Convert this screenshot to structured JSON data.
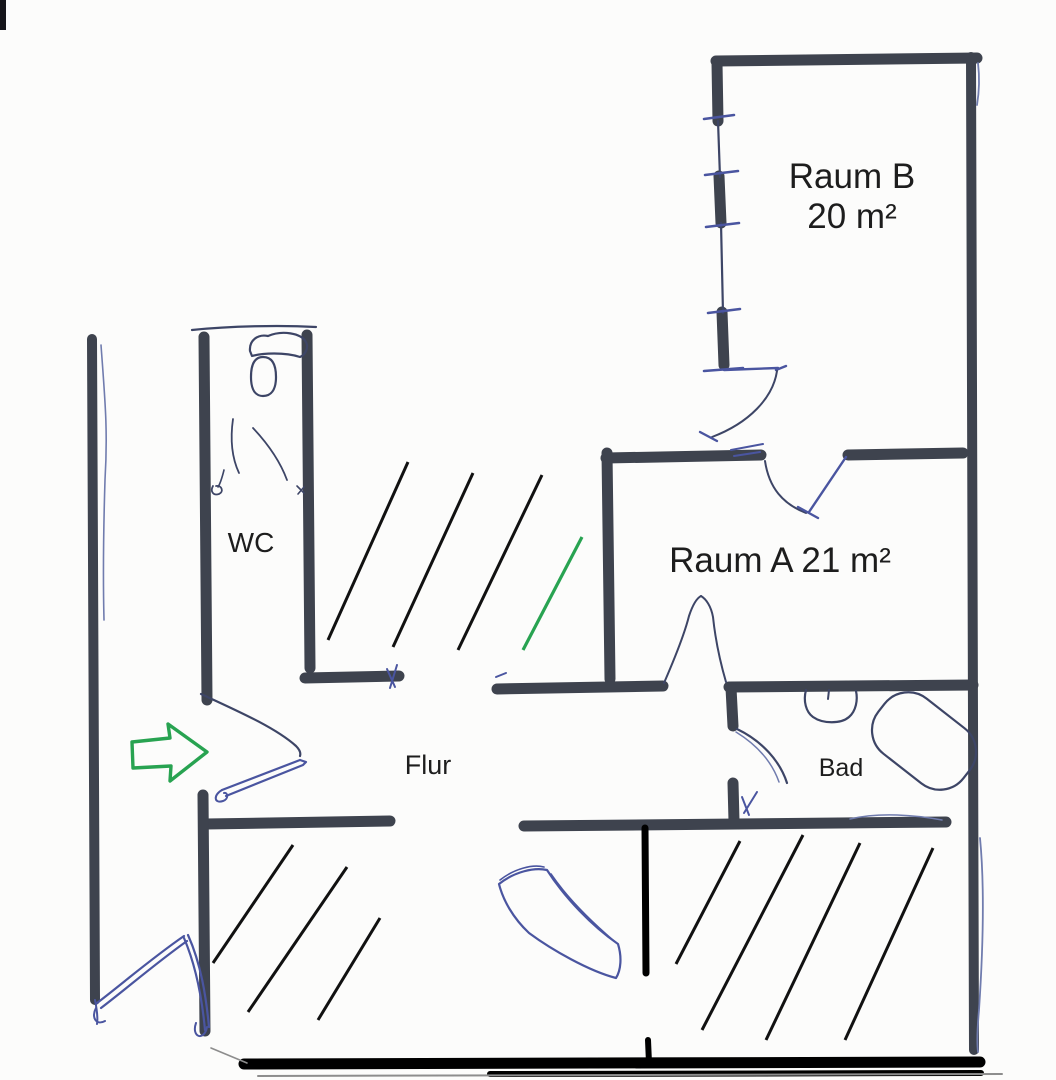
{
  "canvas": {
    "width": 1056,
    "height": 1080,
    "background": "#fcfcfb"
  },
  "palette": {
    "wall": "#3e434e",
    "pen": "#3d4566",
    "pen_blue": "#4a55a0",
    "pen_light": "#707cae",
    "hatch": "#111111",
    "black": "#000000",
    "green": "#28a351",
    "grey": "#8d8d8d",
    "text": "#1d1d1d"
  },
  "rooms": {
    "raum_b": {
      "name": "Raum B",
      "area": "20 m²"
    },
    "raum_a": {
      "label": "Raum A 21 m²"
    },
    "wc": {
      "label": "WC"
    },
    "flur": {
      "label": "Flur"
    },
    "bad": {
      "label": "Bad"
    }
  },
  "plan": {
    "walls": [
      {
        "n": "outer-wall-left",
        "x1": 92,
        "y1": 339,
        "x2": 95,
        "y2": 1000,
        "w": 10
      },
      {
        "n": "raum-b-wall-top",
        "x1": 716,
        "y1": 61,
        "x2": 977,
        "y2": 58,
        "w": 11
      },
      {
        "n": "outer-wall-right",
        "x1": 971,
        "y1": 57,
        "x2": 974,
        "y2": 1050,
        "w": 10
      },
      {
        "n": "raum-b-wall-left-a",
        "x1": 717,
        "y1": 63,
        "x2": 718,
        "y2": 121,
        "w": 11
      },
      {
        "n": "raum-b-wall-left-b",
        "x1": 719,
        "y1": 176,
        "x2": 721,
        "y2": 223,
        "w": 11
      },
      {
        "n": "raum-b-wall-left-c",
        "x1": 722,
        "y1": 312,
        "x2": 724,
        "y2": 365,
        "w": 11
      },
      {
        "n": "raum-a-wall-top-left",
        "x1": 606,
        "y1": 458,
        "x2": 761,
        "y2": 455,
        "w": 11
      },
      {
        "n": "raum-a-wall-top-right",
        "x1": 848,
        "y1": 455,
        "x2": 963,
        "y2": 453,
        "w": 11
      },
      {
        "n": "raum-a-wall-left",
        "x1": 607,
        "y1": 453,
        "x2": 610,
        "y2": 679,
        "w": 11
      },
      {
        "n": "flur-wall-top",
        "x1": 497,
        "y1": 689,
        "x2": 663,
        "y2": 686,
        "w": 11
      },
      {
        "n": "bad-wall-top",
        "x1": 729,
        "y1": 687,
        "x2": 973,
        "y2": 685,
        "w": 11
      },
      {
        "n": "bad-wall-left-a",
        "x1": 731,
        "y1": 688,
        "x2": 733,
        "y2": 726,
        "w": 11
      },
      {
        "n": "bad-wall-left-b",
        "x1": 733,
        "y1": 783,
        "x2": 734,
        "y2": 821,
        "w": 11
      },
      {
        "n": "flur-wall-bottom-left",
        "x1": 206,
        "y1": 824,
        "x2": 390,
        "y2": 821,
        "w": 11
      },
      {
        "n": "flur-wall-bottom-right",
        "x1": 524,
        "y1": 826,
        "x2": 946,
        "y2": 822,
        "w": 11
      },
      {
        "n": "wc-wall-left-upper",
        "x1": 204,
        "y1": 337,
        "x2": 207,
        "y2": 700,
        "w": 11
      },
      {
        "n": "wc-wall-left-lower",
        "x1": 203,
        "y1": 795,
        "x2": 205,
        "y2": 1031,
        "w": 11
      },
      {
        "n": "wc-wall-right",
        "x1": 307,
        "y1": 335,
        "x2": 310,
        "y2": 668,
        "w": 11
      },
      {
        "n": "wc-wall-corner",
        "x1": 305,
        "y1": 678,
        "x2": 399,
        "y2": 676,
        "w": 11
      },
      {
        "n": "black-wall-vertical",
        "x1": 645,
        "y1": 828,
        "x2": 646,
        "y2": 973,
        "w": 7,
        "c": "black"
      },
      {
        "n": "black-wall-vertical-lower",
        "x1": 648,
        "y1": 1040,
        "x2": 649,
        "y2": 1063,
        "w": 6,
        "c": "black"
      },
      {
        "n": "outer-wall-bottom",
        "x1": 244,
        "y1": 1064,
        "x2": 980,
        "y2": 1062,
        "w": 11,
        "c": "black"
      },
      {
        "n": "outer-wall-bottom-2",
        "x1": 490,
        "y1": 1074,
        "x2": 981,
        "y2": 1073,
        "w": 6,
        "c": "black"
      }
    ],
    "pen_paths": [
      {
        "n": "wc-wall-top-sketch",
        "d": "M 192,330 C 230,326 280,325 316,327",
        "w": 2.2
      },
      {
        "n": "toilet-tank-sketch",
        "d": "M 250,351 C 249,340 258,334 268,336 C 282,330 301,333 306,342 C 309,348 305,355 300,357 C 285,352 262,353 252,356 Z",
        "w": 2.2
      },
      {
        "n": "toilet-bowl-sketch",
        "d": "M 263,357 C 273,357 276,366 276,377 C 276,390 271,396 263,396 C 255,396 251,389 251,377 C 251,365 254,357 263,357",
        "w": 2.2
      },
      {
        "n": "wc-sketch-curve",
        "d": "M 233,419 C 230,440 232,458 239,473",
        "w": 1.8
      },
      {
        "n": "wc-sketch-curve",
        "d": "M 253,428 C 268,444 280,461 287,480",
        "w": 1.8
      },
      {
        "n": "wc-sketch-curve",
        "d": "M 224,470 C 222,478 220,484 218,487",
        "w": 1.6
      },
      {
        "n": "wc-hinge-circle",
        "d": "M 213,486 C 210,491 213,496 219,494 C 224,492 222,485 216,486",
        "w": 1.8
      },
      {
        "n": "wc-hinge-mark",
        "d": "M 297,486 L 304,493 M 304,487 L 298,494",
        "w": 1.6
      },
      {
        "n": "left-wall-pen-line",
        "d": "M 101,345 C 105,400 108,430 105,480 C 103,545 103,580 104,620",
        "w": 1.6,
        "c": "pen_light"
      },
      {
        "n": "raum-b-wall-thin",
        "d": "M 718,121 L 720,177 M 721,223 L 723,313",
        "w": 2.2
      },
      {
        "n": "window-ticks",
        "d": "M 704,119 L 734,115 M 705,175 L 738,171 M 706,227 L 739,223 M 708,313 L 740,309 M 704,371 L 743,368",
        "w": 2.6,
        "c": "pen_blue"
      },
      {
        "n": "raum-b-door-line",
        "d": "M 724,370 L 778,368 M 786,366 L 776,370",
        "w": 2.4,
        "c": "pen_blue"
      },
      {
        "n": "raum-b-door-swing",
        "d": "M 777,371 C 773,398 749,423 712,437",
        "w": 2
      },
      {
        "n": "raum-b-door-tick",
        "d": "M 700,432 L 717,441",
        "w": 2.4,
        "c": "pen_blue"
      },
      {
        "n": "raum-a-door-leaf",
        "d": "M 846,457 L 809,512",
        "w": 2.4,
        "c": "pen_blue"
      },
      {
        "n": "raum-a-door-swing",
        "d": "M 765,461 C 769,488 783,504 806,513",
        "w": 2
      },
      {
        "n": "raum-a-door-tick",
        "d": "M 798,507 L 818,518",
        "w": 2.4,
        "c": "pen_blue"
      },
      {
        "n": "raum-a-door-scribble",
        "d": "M 731,450 L 763,444 M 734,456 L 760,452",
        "w": 2,
        "c": "pen_blue"
      },
      {
        "n": "flur-door-swing",
        "d": "M 664,683 C 674,660 684,636 689,616 C 693,604 697,598 701,596",
        "w": 2
      },
      {
        "n": "flur-door-swing",
        "d": "M 726,682 C 719,658 715,636 713,617 C 711,606 706,599 701,596",
        "w": 2
      },
      {
        "n": "bad-door-swing",
        "d": "M 737,729 C 762,741 780,761 787,783",
        "w": 2.2
      },
      {
        "n": "bad-door-swing-2",
        "d": "M 736,732 C 757,745 772,762 779,782",
        "w": 1.5,
        "c": "pen_light"
      },
      {
        "n": "bad-door-scribble",
        "d": "M 744,813 L 757,792 M 749,815 L 742,797",
        "w": 2,
        "c": "pen_blue"
      },
      {
        "n": "sink-sketch",
        "d": "M 806,690 C 803,701 806,712 813,717 C 823,724 841,724 849,717 C 856,711 858,700 856,691",
        "w": 2.2
      },
      {
        "n": "sink-faucet-mark",
        "d": "M 829,690 L 828,699",
        "w": 2
      },
      {
        "n": "bad-bottom-sketch",
        "d": "M 850,819 C 880,812 915,815 942,820",
        "w": 1.5,
        "c": "pen_light"
      },
      {
        "n": "right-wall-pen-line",
        "d": "M 980,838 C 985,890 983,950 979,1010 C 977,1032 977,1044 978,1052",
        "w": 1.8,
        "c": "pen_light"
      },
      {
        "n": "right-wall-pen-line-top",
        "d": "M 978,63 C 980,80 979,93 977,105",
        "w": 1.8,
        "c": "pen_light"
      },
      {
        "n": "entry-door-swing-left",
        "d": "M 97,1003 C 122,984 152,958 184,936 M 101,1008 C 126,989 156,963 187,941",
        "w": 2.2,
        "c": "pen_blue"
      },
      {
        "n": "entry-door-swing-right",
        "d": "M 184,938 C 196,966 202,998 205,1030 M 188,935 C 201,964 206,996 209,1027",
        "w": 2.2,
        "c": "pen_blue"
      },
      {
        "n": "entry-door-scribble",
        "d": "M 96,1008 C 91,1017 96,1026 105,1021 M 196,1023 C 191,1037 204,1042 207,1027",
        "w": 2,
        "c": "pen_blue"
      },
      {
        "n": "left-wall-end-scribble",
        "d": "M 95,1000 C 97,1010 98,1018 97,1024",
        "w": 2,
        "c": "pen_blue"
      },
      {
        "n": "bottom-diag-mark",
        "d": "M 211,1048 L 247,1063",
        "w": 1.6,
        "c": "grey"
      },
      {
        "n": "bottom-underline",
        "d": "M 258,1076 L 1002,1074",
        "w": 2,
        "c": "grey"
      },
      {
        "n": "wc-door-swing",
        "d": "M 201,694 C 240,712 276,728 296,746 C 300,750 301,753 300,756",
        "w": 2.2
      },
      {
        "n": "wc-door-leaf",
        "d": "M 222,790 L 300,760 M 226,796 L 303,765 M 300,760 L 306,762 L 303,765",
        "w": 2.2,
        "c": "pen_blue"
      },
      {
        "n": "wc-door-hinge-loop",
        "d": "M 222,790 C 213,795 214,804 223,801 C 229,799 228,792 224,793",
        "w": 2,
        "c": "pen_blue"
      },
      {
        "n": "curved-band-sketch",
        "d": "M 499,884 C 514,872 534,867 547,870 C 565,898 592,926 618,944 C 622,957 621,970 616,978 C 589,971 552,950 529,933 C 513,918 503,900 499,884 Z",
        "w": 2.2,
        "c": "pen_blue"
      },
      {
        "n": "curved-band-inner-line",
        "d": "M 551,874 C 568,899 593,923 614,941",
        "w": 1.6,
        "c": "pen_blue"
      },
      {
        "n": "curved-band-top-line",
        "d": "M 500,880 C 514,869 532,864 544,867",
        "w": 1.6,
        "c": "pen_blue"
      },
      {
        "n": "flur-wall-tick",
        "d": "M 496,677 L 506,673",
        "w": 2,
        "c": "pen_blue"
      },
      {
        "n": "wc-corner-scribble",
        "d": "M 390,688 L 397,665 M 395,687 L 387,669",
        "w": 2,
        "c": "pen_blue"
      }
    ],
    "hatch_groups": [
      {
        "n": "hatch-line-middle",
        "lines": [
          [
            408,
            462,
            328,
            640
          ],
          [
            473,
            473,
            393,
            647
          ],
          [
            542,
            475,
            458,
            650
          ]
        ]
      },
      {
        "n": "hatch-line-bottom-left",
        "lines": [
          [
            293,
            845,
            213,
            963
          ],
          [
            347,
            867,
            248,
            1012
          ],
          [
            380,
            918,
            318,
            1020
          ]
        ]
      },
      {
        "n": "hatch-line-bottom-right",
        "lines": [
          [
            740,
            841,
            676,
            964
          ],
          [
            803,
            835,
            702,
            1030
          ],
          [
            860,
            843,
            766,
            1040
          ],
          [
            933,
            848,
            845,
            1040
          ]
        ]
      }
    ],
    "green_line": [
      582,
      537,
      523,
      650
    ],
    "arrow_points": "132,742 170,738 168,724 207,752 170,781 171,766 133,768",
    "bathtub": {
      "cx": 924,
      "cy": 741,
      "w": 108,
      "h": 70,
      "rx": 30,
      "rot": 38
    },
    "scan_mark": {
      "x": 0,
      "y": 0,
      "w": 6,
      "h": 30,
      "color": "#15151a"
    }
  }
}
